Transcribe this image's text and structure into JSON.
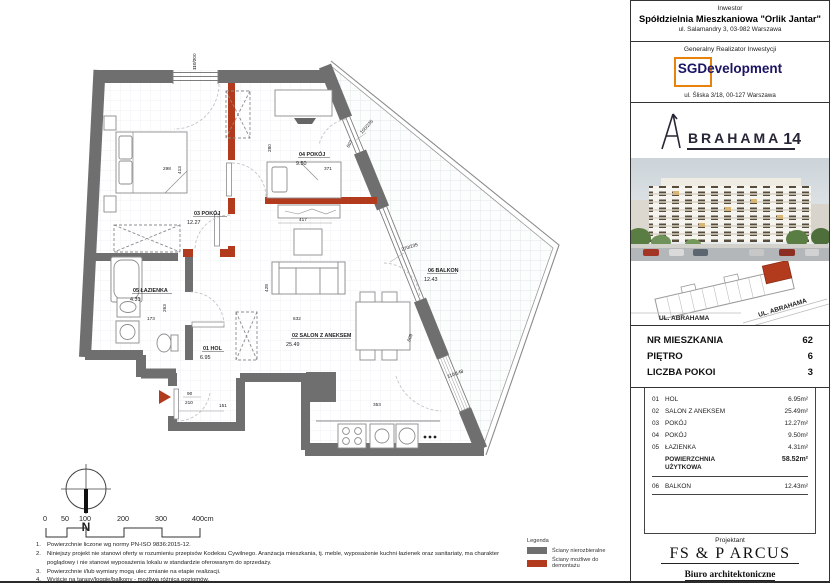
{
  "plan": {
    "rooms": {
      "r01": {
        "name": "01 HOL",
        "area": "6.95"
      },
      "r02": {
        "name": "02 SALON Z ANEKSEM",
        "area": "25.49"
      },
      "r03": {
        "name": "03 POKÓJ",
        "area": "12.27"
      },
      "r04": {
        "name": "04 POKÓJ",
        "area": "9.50"
      },
      "r05": {
        "name": "05 ŁAZIENKA",
        "area": "4.31"
      },
      "r06": {
        "name": "06 BALKON",
        "area": "12.43"
      }
    },
    "dims": {
      "top_window": "110/200",
      "bed03_w": "298",
      "bed03_h": "413",
      "room04_w": "280",
      "bed04": "371",
      "desk04": "417",
      "win04": "100/235",
      "win04_len": "607",
      "salon_win": "270/235",
      "wall_len": "609",
      "balc_door": "110/148",
      "entry_door_w": "90",
      "entry_door_h": "210",
      "entry_w": "151",
      "bath_w": "173",
      "bath_h": "263",
      "salon_w": "632",
      "sofa": "428",
      "kitchen": "353"
    },
    "compass_n": "N",
    "scale": {
      "t0": "0",
      "t1": "50",
      "t2": "100",
      "t3": "200",
      "t4": "300",
      "t5": "400cm"
    }
  },
  "notes": {
    "m1": "1.",
    "n1": "Powierzchnie liczone wg normy PN-ISO 9836:2015-12.",
    "m2": "2.",
    "n2": "Niniejszy projekt nie stanowi oferty w rozumieniu przepisów Kodeksu Cywilnego. Aranżacja mieszkania, tj. meble, wyposażenie kuchni łazienek oraz sanitariaty, ma charakter poglądowy i nie stanowi wyposażenia lokalu w standardzie oferowanym do sprzedaży.",
    "m3": "3.",
    "n3": "Powierzchnie i/lub wymiary mogą ulec zmianie na etapie realizacji.",
    "m4": "4.",
    "n4": "Wyjście na tarasy/loggie/balkony - możliwa różnica poziomów."
  },
  "legend": {
    "title": "Legenda",
    "wall_fixed": "Ściany nierozbieralne",
    "wall_removable": "Ściany możliwe do demontażu",
    "gray": "#6f6f6f",
    "red": "#b23a1d"
  },
  "investor": {
    "label": "Inwestor",
    "name": "Spółdzielnia Mieszkaniowa \"Orlik Jantar\"",
    "address": "ul. Salamandry 3, 03-982 Warszawa"
  },
  "realizator": {
    "label": "Generalny Realizator Inwestycji",
    "brand": "SGDevelopment",
    "address": "ul. Śliska 3/18, 00-127 Warszawa"
  },
  "brand": {
    "rest": "BRAHAMA",
    "number": "14"
  },
  "siteplan": {
    "street_bottom": "UL. ABRAHAMA",
    "street_right": "UL. ABRAHAMA"
  },
  "unit": {
    "rows": [
      {
        "label": "NR MIESZKANIA",
        "value": "62"
      },
      {
        "label": "PIĘTRO",
        "value": "6"
      },
      {
        "label": "LICZBA POKOI",
        "value": "3"
      }
    ]
  },
  "areas": {
    "rows": [
      {
        "no": "01",
        "name": "HOL",
        "value": "6.95m²"
      },
      {
        "no": "02",
        "name": "SALON Z ANEKSEM",
        "value": "25.49m²"
      },
      {
        "no": "03",
        "name": "POKÓJ",
        "value": "12.27m²"
      },
      {
        "no": "04",
        "name": "POKÓJ",
        "value": "9.50m²"
      },
      {
        "no": "05",
        "name": "ŁAZIENKA",
        "value": "4.31m²"
      }
    ],
    "total_label": "POWIERZCHNIA UŻYTKOWA",
    "total_value": "58.52m²",
    "balkon": {
      "no": "06",
      "name": "BALKON",
      "value": "12.43m²"
    }
  },
  "designer": {
    "label": "Projektant",
    "name": "FS & P ARCUS",
    "subtitle": "Biuro architektoniczne",
    "address": "ul. gen. Abrahama 12 lok. 10 | 03-982 Warszawa",
    "contact": "www.fsparcus.com.pl | fsparcus@fsparcus.com.pl"
  }
}
